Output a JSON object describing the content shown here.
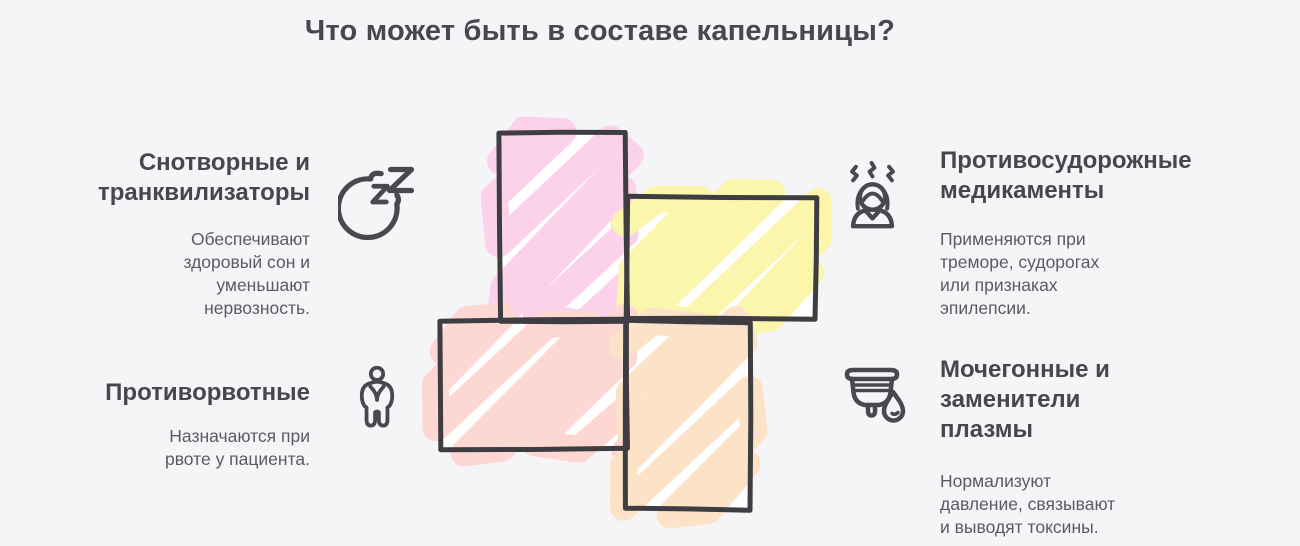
{
  "title": "Что может быть в составе капельницы?",
  "sections": {
    "sedatives": {
      "heading": "Снотворные и\nтранквилизаторы",
      "body": "Обеспечивают\nздоровый сон и\nуменьшают\nнервозность.",
      "icon": "moon-zzz-icon"
    },
    "anticonvulsants": {
      "heading": "Противосудорожные\nмедикаменты",
      "body": "Применяются при\nтреморе, судорогах\nили признаках\nэпилепсии.",
      "icon": "tremor-person-icon"
    },
    "antiemetics": {
      "heading": "Противорвотные",
      "body": "Назначаются при\nрвоте у пациента.",
      "icon": "nausea-person-icon"
    },
    "diuretics": {
      "heading": "Мочегонные и\nзаменители\nплазмы",
      "body": "Нормализуют\nдавление, связывают\nи выводят токсины.",
      "icon": "cup-droplet-icon"
    }
  },
  "diagram": {
    "colors": {
      "pink": "#fbd2ea",
      "yellow": "#fcf5ac",
      "salmon": "#fdd8d2",
      "peach": "#fce3c8",
      "border": "#3d3d42",
      "inner_background": "#ffffff"
    }
  },
  "page": {
    "background": "#f5f5f8",
    "title_color": "#47474f",
    "heading_color": "#46464d",
    "body_color": "#5a5a62"
  }
}
